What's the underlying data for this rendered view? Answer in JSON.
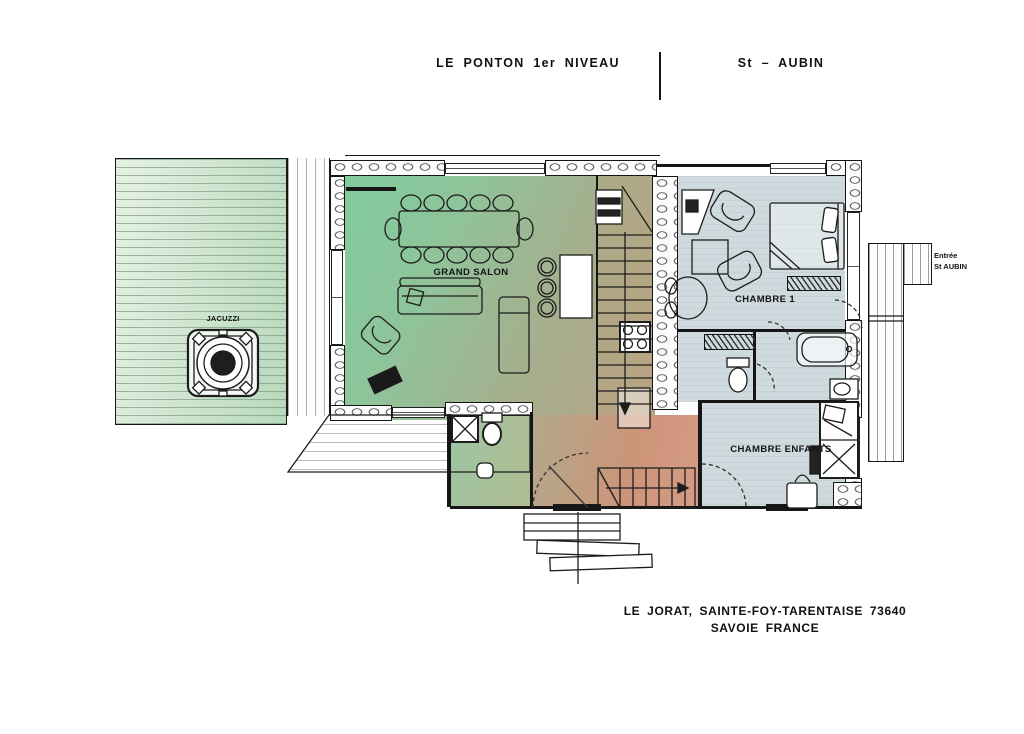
{
  "header": {
    "title_left": "LE PONTON 1er NIVEAU",
    "title_right": "St – AUBIN"
  },
  "labels": {
    "grand_salon": "GRAND SALON",
    "chambre_1": "CHAMBRE 1",
    "chambre_enfants": "CHAMBRE ENFANTS",
    "jacuzzi": "JACUZZI",
    "entree_line1": "Entrée",
    "entree_line2": "St AUBIN"
  },
  "footer": {
    "address_line1": "LE JORAT, SAINTE-FOY-TARENTAISE 73640",
    "address_line2": "SAVOIE FRANCE"
  },
  "colors": {
    "salon_green": "#7ecb9e",
    "floor_tan": "#b3a488",
    "hall_salmon": "#cf9078",
    "bedroom_blue": "#cdd9de",
    "deck_green": "#dcead8",
    "line_ink": "#161616"
  }
}
